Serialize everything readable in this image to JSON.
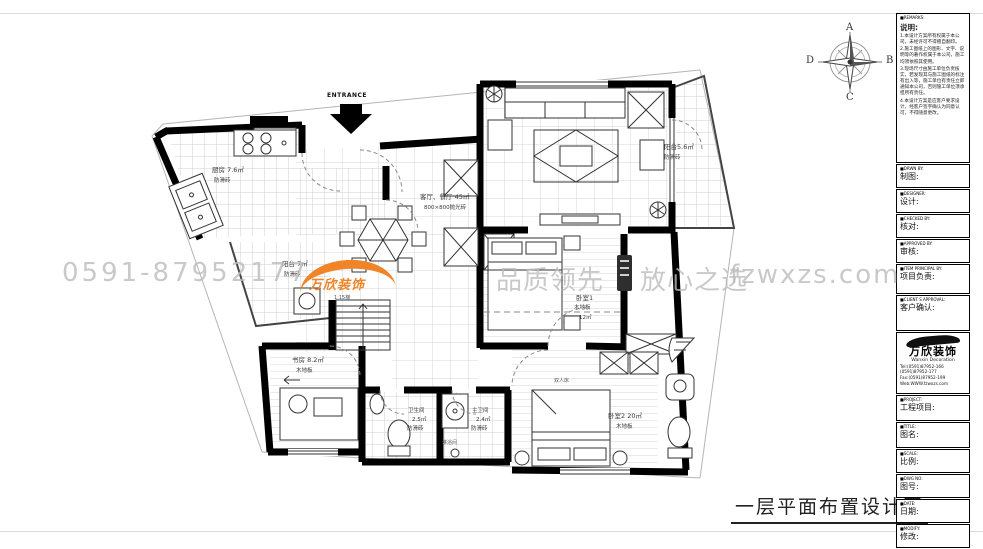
{
  "sheet": {
    "title": "一层平面布置设计图"
  },
  "compass": {
    "top": "A",
    "right": "B",
    "bottom": "C",
    "left": "D"
  },
  "plan": {
    "entrance": "ENTRANCE",
    "rooms": {
      "kitchen": {
        "name": "厨房",
        "area": "7.6㎡",
        "floor": "防滑砖"
      },
      "living": {
        "name": "客厅、餐厅",
        "area": "45㎡",
        "floor": "800×800抛光砖"
      },
      "balcony_right": {
        "name": "阳台",
        "area": "5.6㎡",
        "floor": "防滑砖"
      },
      "balcony_left": {
        "name": "阳台",
        "area": "7㎡",
        "floor": "防滑砖"
      },
      "bedroom1": {
        "name": "卧室1",
        "floor": "木地板",
        "area": "12㎡"
      },
      "study": {
        "name": "书房",
        "area": "8.2㎡",
        "floor": "木地板"
      },
      "bath": {
        "name": "卫生间",
        "area": "2.5㎡",
        "floor": "防滑砖"
      },
      "master_bath": {
        "name": "主卫间",
        "area": "2.4㎡",
        "floor": "防滑砖"
      },
      "shower": {
        "name": "淋浴间"
      },
      "bedroom2": {
        "name": "卧室2",
        "area": "20㎡",
        "floor": "木地板"
      }
    },
    "stairs_label": "1:15梯",
    "double_bed_label": "双人床"
  },
  "watermark": {
    "phone": "0591-87952177",
    "logo": "万欣装饰",
    "slogan1": "品质领先",
    "slogan2": "放心之选",
    "site": "fzwxzs.com",
    "accent": "#f08428"
  },
  "titleblock": {
    "remarks_en": "■REMARKS:",
    "remarks_cn": "说明:",
    "notes": [
      "1.本设计方案所有权属于本公司，未经许可不得擅自翻印。",
      "2.施工图纸上的图形、文字、说明等的著作权属于本公司，施工均须依照其使用。",
      "3.现场尺寸由施工单位负责核实，若发现其与施工图纸的标注有出入等，施工单位有责任立即通知本公司，否则施工单位须承担所有责任。",
      "4.本设计方案是应客户要求设计，经客户签字确认为同意认可，不得随意更改。"
    ],
    "fields": [
      {
        "en": "■DRWN BY:",
        "cn": "制图:"
      },
      {
        "en": "■DESIGNER:",
        "cn": "设计:"
      },
      {
        "en": "■CHECKED BY:",
        "cn": "核对:"
      },
      {
        "en": "■APPROVED BY:",
        "cn": "审核:"
      },
      {
        "en": "■ITEM PRINCIPAL BY:",
        "cn": "项目负责:"
      },
      {
        "en": "■CLIENT S APPROVAL:",
        "cn": "客户确认:"
      }
    ],
    "company": {
      "cn": "万欣装饰",
      "en": "Wanxin Decoration",
      "tel1": "Tel:(0591)87952-166",
      "tel2": "(0591)87952-177",
      "fax": "Fax:(0591)87952-199",
      "web": "Web:WWW.fzwxzs.com"
    },
    "fields2": [
      {
        "en": "■PROJECT:",
        "cn": "工程项目:"
      },
      {
        "en": "■TITLE:",
        "cn": "图名:"
      },
      {
        "en": "■SCALE:",
        "cn": "比例:"
      },
      {
        "en": "■DWG NO:",
        "cn": "图号:"
      },
      {
        "en": "■DATE:",
        "cn": "日期:"
      },
      {
        "en": "■MODIFY:",
        "cn": "修改:"
      }
    ]
  }
}
